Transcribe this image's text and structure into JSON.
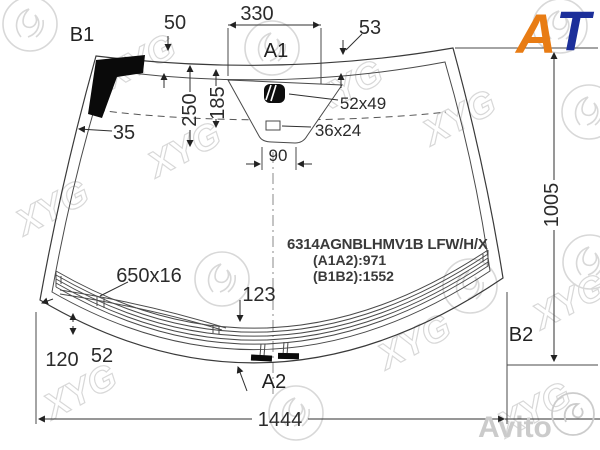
{
  "diagram": {
    "part_block": {
      "code": "6314AGNBLHMV1B LFW/H/X",
      "a1a2": "(A1A2):971",
      "b1b2": "(B1B2):1552"
    },
    "points": {
      "a1": "A1",
      "a2": "A2",
      "b1": "B1",
      "b2": "B2"
    },
    "dimensions": {
      "top_band_left": "50",
      "mirror_area_width": "330",
      "top_band_right": "53",
      "drop_center": "250",
      "drop_mirror": "185",
      "side_band": "35",
      "mirror_mount": "52x49",
      "sensor_window": "36x24",
      "mount_base": "90",
      "glass_height": "1005",
      "glass_width": "1444",
      "wiper_deicer": "650x16",
      "heater_drop": "123",
      "heater_offset": "120",
      "heater_gap": "52"
    },
    "colors": {
      "line": "#3a3a3a",
      "accent_orange": "#e87c14",
      "accent_blue": "#1c2f9a",
      "watermark": "#d8d8d8"
    }
  },
  "watermarks": {
    "xyg": "XYG",
    "avito": "Avito",
    "logo_a": "A",
    "logo_t": "T"
  }
}
